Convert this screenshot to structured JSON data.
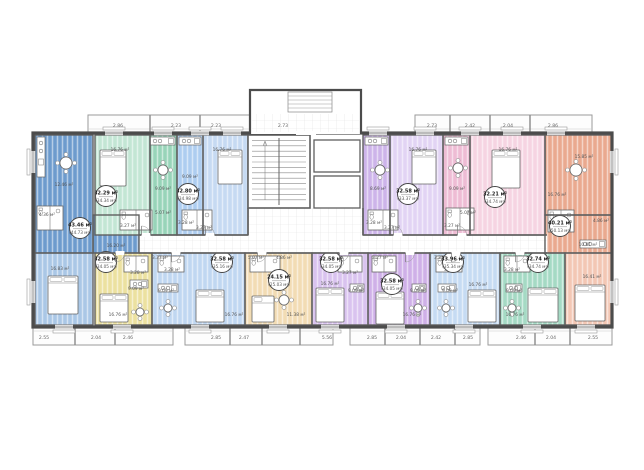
{
  "plan": {
    "area_unit": "м²",
    "units": [
      {
        "id": "1",
        "label": "apartment-left-end",
        "badge": {
          "main": "43.46 м²",
          "total": "(44.73 м²)",
          "x": 80,
          "y": 228
        },
        "parts": [
          {
            "x": 35,
            "y": 135,
            "w": 58,
            "h": 118,
            "c": "#6d9bcd"
          },
          {
            "x": 93,
            "y": 215,
            "w": 46,
            "h": 38,
            "c": "#6d9bcd"
          },
          {
            "x": 35,
            "y": 253,
            "w": 58,
            "h": 72,
            "c": "#aac7e6"
          }
        ],
        "rooms": [
          {
            "t": "12.46 м²",
            "x": 64,
            "y": 186
          },
          {
            "t": "4.36 м²",
            "x": 47,
            "y": 216
          },
          {
            "t": "16.20 м²",
            "x": 116,
            "y": 247
          },
          {
            "t": "16.83 м²",
            "x": 60,
            "y": 270
          }
        ],
        "furn": [
          {
            "k": "kitchen",
            "x": 37,
            "y": 137,
            "w": 8,
            "h": 40,
            "o": "v"
          },
          {
            "k": "table",
            "x": 66,
            "y": 163,
            "r": 6
          },
          {
            "k": "wet",
            "x": 37,
            "y": 206,
            "w": 26,
            "h": 24
          },
          {
            "k": "bed",
            "x": 48,
            "y": 276,
            "w": 30,
            "h": 38
          }
        ]
      },
      {
        "id": "2",
        "label": "apartment-top-green",
        "badge": {
          "main": "32.29 м²",
          "total": "(34.34 м²)",
          "x": 106,
          "y": 196
        },
        "parts": [
          {
            "x": 95,
            "y": 135,
            "w": 55,
            "h": 100,
            "c": "#c3e6d4"
          },
          {
            "x": 150,
            "y": 135,
            "w": 27,
            "h": 100,
            "c": "#98d4b9"
          }
        ],
        "rooms": [
          {
            "t": "16.76 м²",
            "x": 120,
            "y": 151
          },
          {
            "t": "9.09 м²",
            "x": 163,
            "y": 190
          },
          {
            "t": "5.07 м²",
            "x": 163,
            "y": 214
          },
          {
            "t": "3.27 м²",
            "x": 128,
            "y": 227
          }
        ],
        "furn": [
          {
            "k": "bed",
            "x": 100,
            "y": 150,
            "w": 26,
            "h": 36
          },
          {
            "k": "kitchen",
            "x": 150,
            "y": 137,
            "w": 25,
            "h": 8,
            "o": "h"
          },
          {
            "k": "table",
            "x": 163,
            "y": 170,
            "r": 5
          },
          {
            "k": "wet",
            "x": 120,
            "y": 210,
            "w": 32,
            "h": 20
          }
        ]
      },
      {
        "id": "3",
        "label": "apartment-top-lightblue",
        "badge": {
          "main": "32.80 м²",
          "total": "(34.98 м²)",
          "x": 188,
          "y": 194
        },
        "parts": [
          {
            "x": 177,
            "y": 135,
            "w": 26,
            "h": 100,
            "c": "#aecdf0"
          },
          {
            "x": 203,
            "y": 135,
            "w": 45,
            "h": 100,
            "c": "#c6daf2"
          }
        ],
        "rooms": [
          {
            "t": "9.09 м²",
            "x": 190,
            "y": 178
          },
          {
            "t": "16.76 м²",
            "x": 222,
            "y": 151
          },
          {
            "t": "3.28 м²",
            "x": 186,
            "y": 224
          },
          {
            "t": "3.27 м²",
            "x": 204,
            "y": 229
          }
        ],
        "furn": [
          {
            "k": "bed",
            "x": 218,
            "y": 150,
            "w": 24,
            "h": 34
          },
          {
            "k": "kitchen",
            "x": 179,
            "y": 137,
            "w": 22,
            "h": 8,
            "o": "h"
          },
          {
            "k": "wet",
            "x": 182,
            "y": 210,
            "w": 30,
            "h": 20
          }
        ]
      },
      {
        "id": "4",
        "label": "apartment-top-purple",
        "badge": {
          "main": "32.58 м²",
          "total": "(33.37 м²)",
          "x": 408,
          "y": 194
        },
        "parts": [
          {
            "x": 363,
            "y": 135,
            "w": 27,
            "h": 100,
            "c": "#cdb4ea"
          },
          {
            "x": 390,
            "y": 135,
            "w": 53,
            "h": 100,
            "c": "#e2d4f4"
          }
        ],
        "rooms": [
          {
            "t": "8.69 м²",
            "x": 378,
            "y": 190
          },
          {
            "t": "16.76 м²",
            "x": 418,
            "y": 151
          },
          {
            "t": "3.28 м²",
            "x": 374,
            "y": 224
          },
          {
            "t": "3.27 м²",
            "x": 392,
            "y": 229
          }
        ],
        "furn": [
          {
            "k": "bed",
            "x": 412,
            "y": 150,
            "w": 24,
            "h": 34
          },
          {
            "k": "kitchen",
            "x": 365,
            "y": 137,
            "w": 23,
            "h": 8,
            "o": "h"
          },
          {
            "k": "table",
            "x": 380,
            "y": 170,
            "r": 5
          },
          {
            "k": "wet",
            "x": 368,
            "y": 210,
            "w": 30,
            "h": 20
          }
        ]
      },
      {
        "id": "5",
        "label": "apartment-top-pink",
        "badge": {
          "main": "32.21 м²",
          "total": "(34.74 м²)",
          "x": 495,
          "y": 197
        },
        "parts": [
          {
            "x": 443,
            "y": 135,
            "w": 27,
            "h": 100,
            "c": "#eebcd4"
          },
          {
            "x": 470,
            "y": 135,
            "w": 75,
            "h": 100,
            "c": "#f6d4e2"
          }
        ],
        "rooms": [
          {
            "t": "9.09 м²",
            "x": 457,
            "y": 190
          },
          {
            "t": "16.76 м²",
            "x": 508,
            "y": 151
          },
          {
            "t": "5.07 м²",
            "x": 468,
            "y": 214
          },
          {
            "t": "3.27 м²",
            "x": 452,
            "y": 227
          }
        ],
        "furn": [
          {
            "k": "bed",
            "x": 492,
            "y": 150,
            "w": 28,
            "h": 38
          },
          {
            "k": "kitchen",
            "x": 445,
            "y": 137,
            "w": 23,
            "h": 8,
            "o": "h"
          },
          {
            "k": "table",
            "x": 458,
            "y": 168,
            "r": 5
          },
          {
            "k": "wet",
            "x": 446,
            "y": 208,
            "w": 28,
            "h": 22
          }
        ]
      },
      {
        "id": "6",
        "label": "apartment-right-end",
        "badge": {
          "main": "40.21 м²",
          "total": "(50.13 м²)",
          "x": 560,
          "y": 226
        },
        "parts": [
          {
            "x": 545,
            "y": 135,
            "w": 67,
            "h": 80,
            "c": "#eaa98f"
          },
          {
            "x": 545,
            "y": 215,
            "w": 67,
            "h": 38,
            "c": "#eaa98f"
          },
          {
            "x": 565,
            "y": 253,
            "w": 47,
            "h": 72,
            "c": "#f3c7b4"
          }
        ],
        "rooms": [
          {
            "t": "15.85 м²",
            "x": 584,
            "y": 158
          },
          {
            "t": "16.76 м²",
            "x": 557,
            "y": 196
          },
          {
            "t": "4.86 м²",
            "x": 601,
            "y": 222
          },
          {
            "t": "10.81 м²",
            "x": 588,
            "y": 246
          },
          {
            "t": "16.41 м²",
            "x": 592,
            "y": 278
          }
        ],
        "furn": [
          {
            "k": "table",
            "x": 576,
            "y": 170,
            "r": 6
          },
          {
            "k": "kitchen",
            "x": 580,
            "y": 240,
            "w": 26,
            "h": 8,
            "o": "h"
          },
          {
            "k": "wet",
            "x": 548,
            "y": 210,
            "w": 26,
            "h": 22
          },
          {
            "k": "bed",
            "x": 575,
            "y": 285,
            "w": 30,
            "h": 36
          }
        ]
      },
      {
        "id": "7",
        "label": "apartment-bottom-yellow",
        "badge": {
          "main": "32.58 м²",
          "total": "(34.05 м²)",
          "x": 106,
          "y": 262
        },
        "parts": [
          {
            "x": 95,
            "y": 253,
            "w": 57,
            "h": 72,
            "c": "#ece1a0"
          }
        ],
        "rooms": [
          {
            "t": "3.28 м²",
            "x": 138,
            "y": 274
          },
          {
            "t": "9.09 м²",
            "x": 136,
            "y": 290
          },
          {
            "t": "16.76 м²",
            "x": 118,
            "y": 316
          }
        ],
        "furn": [
          {
            "k": "wet",
            "x": 124,
            "y": 256,
            "w": 24,
            "h": 16
          },
          {
            "k": "kitchen",
            "x": 130,
            "y": 280,
            "w": 18,
            "h": 8,
            "o": "h"
          },
          {
            "k": "bed",
            "x": 100,
            "y": 294,
            "w": 28,
            "h": 28
          },
          {
            "k": "table",
            "x": 140,
            "y": 312,
            "r": 4
          }
        ]
      },
      {
        "id": "8",
        "label": "apartment-bottom-lightblue-left",
        "badge": {
          "main": "32.58 м²",
          "total": "(35.16 м²)",
          "x": 222,
          "y": 262
        },
        "parts": [
          {
            "x": 152,
            "y": 253,
            "w": 93,
            "h": 72,
            "c": "#c0d7f1"
          }
        ],
        "rooms": [
          {
            "t": "3.37 м²",
            "x": 160,
            "y": 259
          },
          {
            "t": "3.28 м²",
            "x": 172,
            "y": 271
          },
          {
            "t": "9.09 м²",
            "x": 166,
            "y": 292
          },
          {
            "t": "16.76 м²",
            "x": 234,
            "y": 316
          }
        ],
        "furn": [
          {
            "k": "wet",
            "x": 158,
            "y": 256,
            "w": 26,
            "h": 16
          },
          {
            "k": "kitchen",
            "x": 158,
            "y": 284,
            "w": 20,
            "h": 8,
            "o": "h"
          },
          {
            "k": "table",
            "x": 168,
            "y": 308,
            "r": 4
          },
          {
            "k": "bed",
            "x": 196,
            "y": 290,
            "w": 28,
            "h": 32
          }
        ]
      },
      {
        "id": "9",
        "label": "apartment-bottom-studio-tan",
        "badge": {
          "main": "24.15 м²",
          "total": "(25.03 м²)",
          "x": 279,
          "y": 280
        },
        "parts": [
          {
            "x": 245,
            "y": 253,
            "w": 67,
            "h": 72,
            "c": "#f2dcb4"
          }
        ],
        "rooms": [
          {
            "t": "5.07 м²",
            "x": 256,
            "y": 259
          },
          {
            "t": "4.86 м²",
            "x": 284,
            "y": 259
          },
          {
            "t": "11.38 м²",
            "x": 296,
            "y": 316
          }
        ],
        "furn": [
          {
            "k": "wet",
            "x": 250,
            "y": 256,
            "w": 30,
            "h": 16
          },
          {
            "k": "bed",
            "x": 252,
            "y": 296,
            "w": 22,
            "h": 26
          },
          {
            "k": "table",
            "x": 284,
            "y": 300,
            "r": 5
          }
        ]
      },
      {
        "id": "10",
        "label": "apartment-bottom-lavender",
        "badge": {
          "main": "32.58 м²",
          "total": "(34.05 м²)",
          "x": 331,
          "y": 262
        },
        "parts": [
          {
            "x": 312,
            "y": 253,
            "w": 56,
            "h": 72,
            "c": "#d9c3ef"
          }
        ],
        "rooms": [
          {
            "t": "3.27 м²",
            "x": 350,
            "y": 274
          },
          {
            "t": "9.09 м²",
            "x": 356,
            "y": 292
          },
          {
            "t": "16.76 м²",
            "x": 330,
            "y": 285
          }
        ],
        "furn": [
          {
            "k": "wet",
            "x": 338,
            "y": 256,
            "w": 24,
            "h": 16
          },
          {
            "k": "kitchen",
            "x": 350,
            "y": 284,
            "w": 14,
            "h": 8,
            "o": "h"
          },
          {
            "k": "bed",
            "x": 316,
            "y": 288,
            "w": 28,
            "h": 34
          }
        ]
      },
      {
        "id": "11",
        "label": "apartment-bottom-purple",
        "badge": {
          "main": "32.58 м²",
          "total": "(34.05 м²)",
          "x": 392,
          "y": 284
        },
        "parts": [
          {
            "x": 368,
            "y": 253,
            "w": 62,
            "h": 72,
            "c": "#cfb0e8"
          }
        ],
        "rooms": [
          {
            "t": "3.27 м²",
            "x": 380,
            "y": 259
          },
          {
            "t": "9.09 м²",
            "x": 418,
            "y": 292
          },
          {
            "t": "16.76 м²",
            "x": 412,
            "y": 316
          }
        ],
        "furn": [
          {
            "k": "wet",
            "x": 372,
            "y": 256,
            "w": 24,
            "h": 16
          },
          {
            "k": "kitchen",
            "x": 412,
            "y": 284,
            "w": 14,
            "h": 8,
            "o": "h"
          },
          {
            "k": "bed",
            "x": 376,
            "y": 292,
            "w": 28,
            "h": 32
          },
          {
            "k": "table",
            "x": 418,
            "y": 308,
            "r": 4
          }
        ]
      },
      {
        "id": "12",
        "label": "apartment-bottom-lightblue-right",
        "badge": {
          "main": "33.96 м²",
          "total": "(35.34 м²)",
          "x": 453,
          "y": 262
        },
        "parts": [
          {
            "x": 430,
            "y": 253,
            "w": 70,
            "h": 72,
            "c": "#c6dbf3"
          }
        ],
        "rooms": [
          {
            "t": "3.37 м²",
            "x": 442,
            "y": 259
          },
          {
            "t": "3.28 м²",
            "x": 452,
            "y": 271
          },
          {
            "t": "9.09 м²",
            "x": 450,
            "y": 292
          },
          {
            "t": "16.76 м²",
            "x": 478,
            "y": 286
          }
        ],
        "furn": [
          {
            "k": "wet",
            "x": 436,
            "y": 256,
            "w": 26,
            "h": 16
          },
          {
            "k": "kitchen",
            "x": 438,
            "y": 284,
            "w": 18,
            "h": 8,
            "o": "h"
          },
          {
            "k": "table",
            "x": 446,
            "y": 308,
            "r": 4
          },
          {
            "k": "bed",
            "x": 468,
            "y": 290,
            "w": 28,
            "h": 32
          }
        ]
      },
      {
        "id": "13",
        "label": "apartment-bottom-green",
        "badge": {
          "main": "32.74 м²",
          "total": "(34.74 м²)",
          "x": 538,
          "y": 262
        },
        "parts": [
          {
            "x": 500,
            "y": 253,
            "w": 65,
            "h": 72,
            "c": "#a5dac4"
          }
        ],
        "rooms": [
          {
            "t": "3.28 м²",
            "x": 512,
            "y": 271
          },
          {
            "t": "9.09 м²",
            "x": 514,
            "y": 292
          },
          {
            "t": "16.76 м²",
            "x": 515,
            "y": 316
          }
        ],
        "furn": [
          {
            "k": "wet",
            "x": 504,
            "y": 256,
            "w": 26,
            "h": 16
          },
          {
            "k": "kitchen",
            "x": 506,
            "y": 284,
            "w": 16,
            "h": 8,
            "o": "h"
          },
          {
            "k": "bed",
            "x": 528,
            "y": 288,
            "w": 30,
            "h": 34
          },
          {
            "k": "table",
            "x": 512,
            "y": 308,
            "r": 4
          }
        ]
      }
    ],
    "dimensions_top": [
      {
        "t": "2.86",
        "x": 118
      },
      {
        "t": "2.23",
        "x": 176
      },
      {
        "t": "2.23",
        "x": 216
      },
      {
        "t": "2.73",
        "x": 283
      },
      {
        "t": "2.73",
        "x": 432
      },
      {
        "t": "2.42",
        "x": 470
      },
      {
        "t": "2.04",
        "x": 508
      },
      {
        "t": "2.86",
        "x": 553
      }
    ],
    "dimensions_bottom": [
      {
        "t": "2.55",
        "x": 44
      },
      {
        "t": "2.04",
        "x": 96
      },
      {
        "t": "2.46",
        "x": 128
      },
      {
        "t": "2.85",
        "x": 216
      },
      {
        "t": "2.47",
        "x": 244
      },
      {
        "t": "5.56",
        "x": 327
      },
      {
        "t": "2.85",
        "x": 372
      },
      {
        "t": "2.04",
        "x": 401
      },
      {
        "t": "2.42",
        "x": 436
      },
      {
        "t": "2.85",
        "x": 468
      },
      {
        "t": "2.46",
        "x": 521
      },
      {
        "t": "2.04",
        "x": 551
      },
      {
        "t": "2.55",
        "x": 593
      }
    ],
    "colors": {
      "wall": "#4c4c4c",
      "partition": "#5f5f5f",
      "corridor": "#ffffff",
      "fixture": "#666666"
    }
  }
}
